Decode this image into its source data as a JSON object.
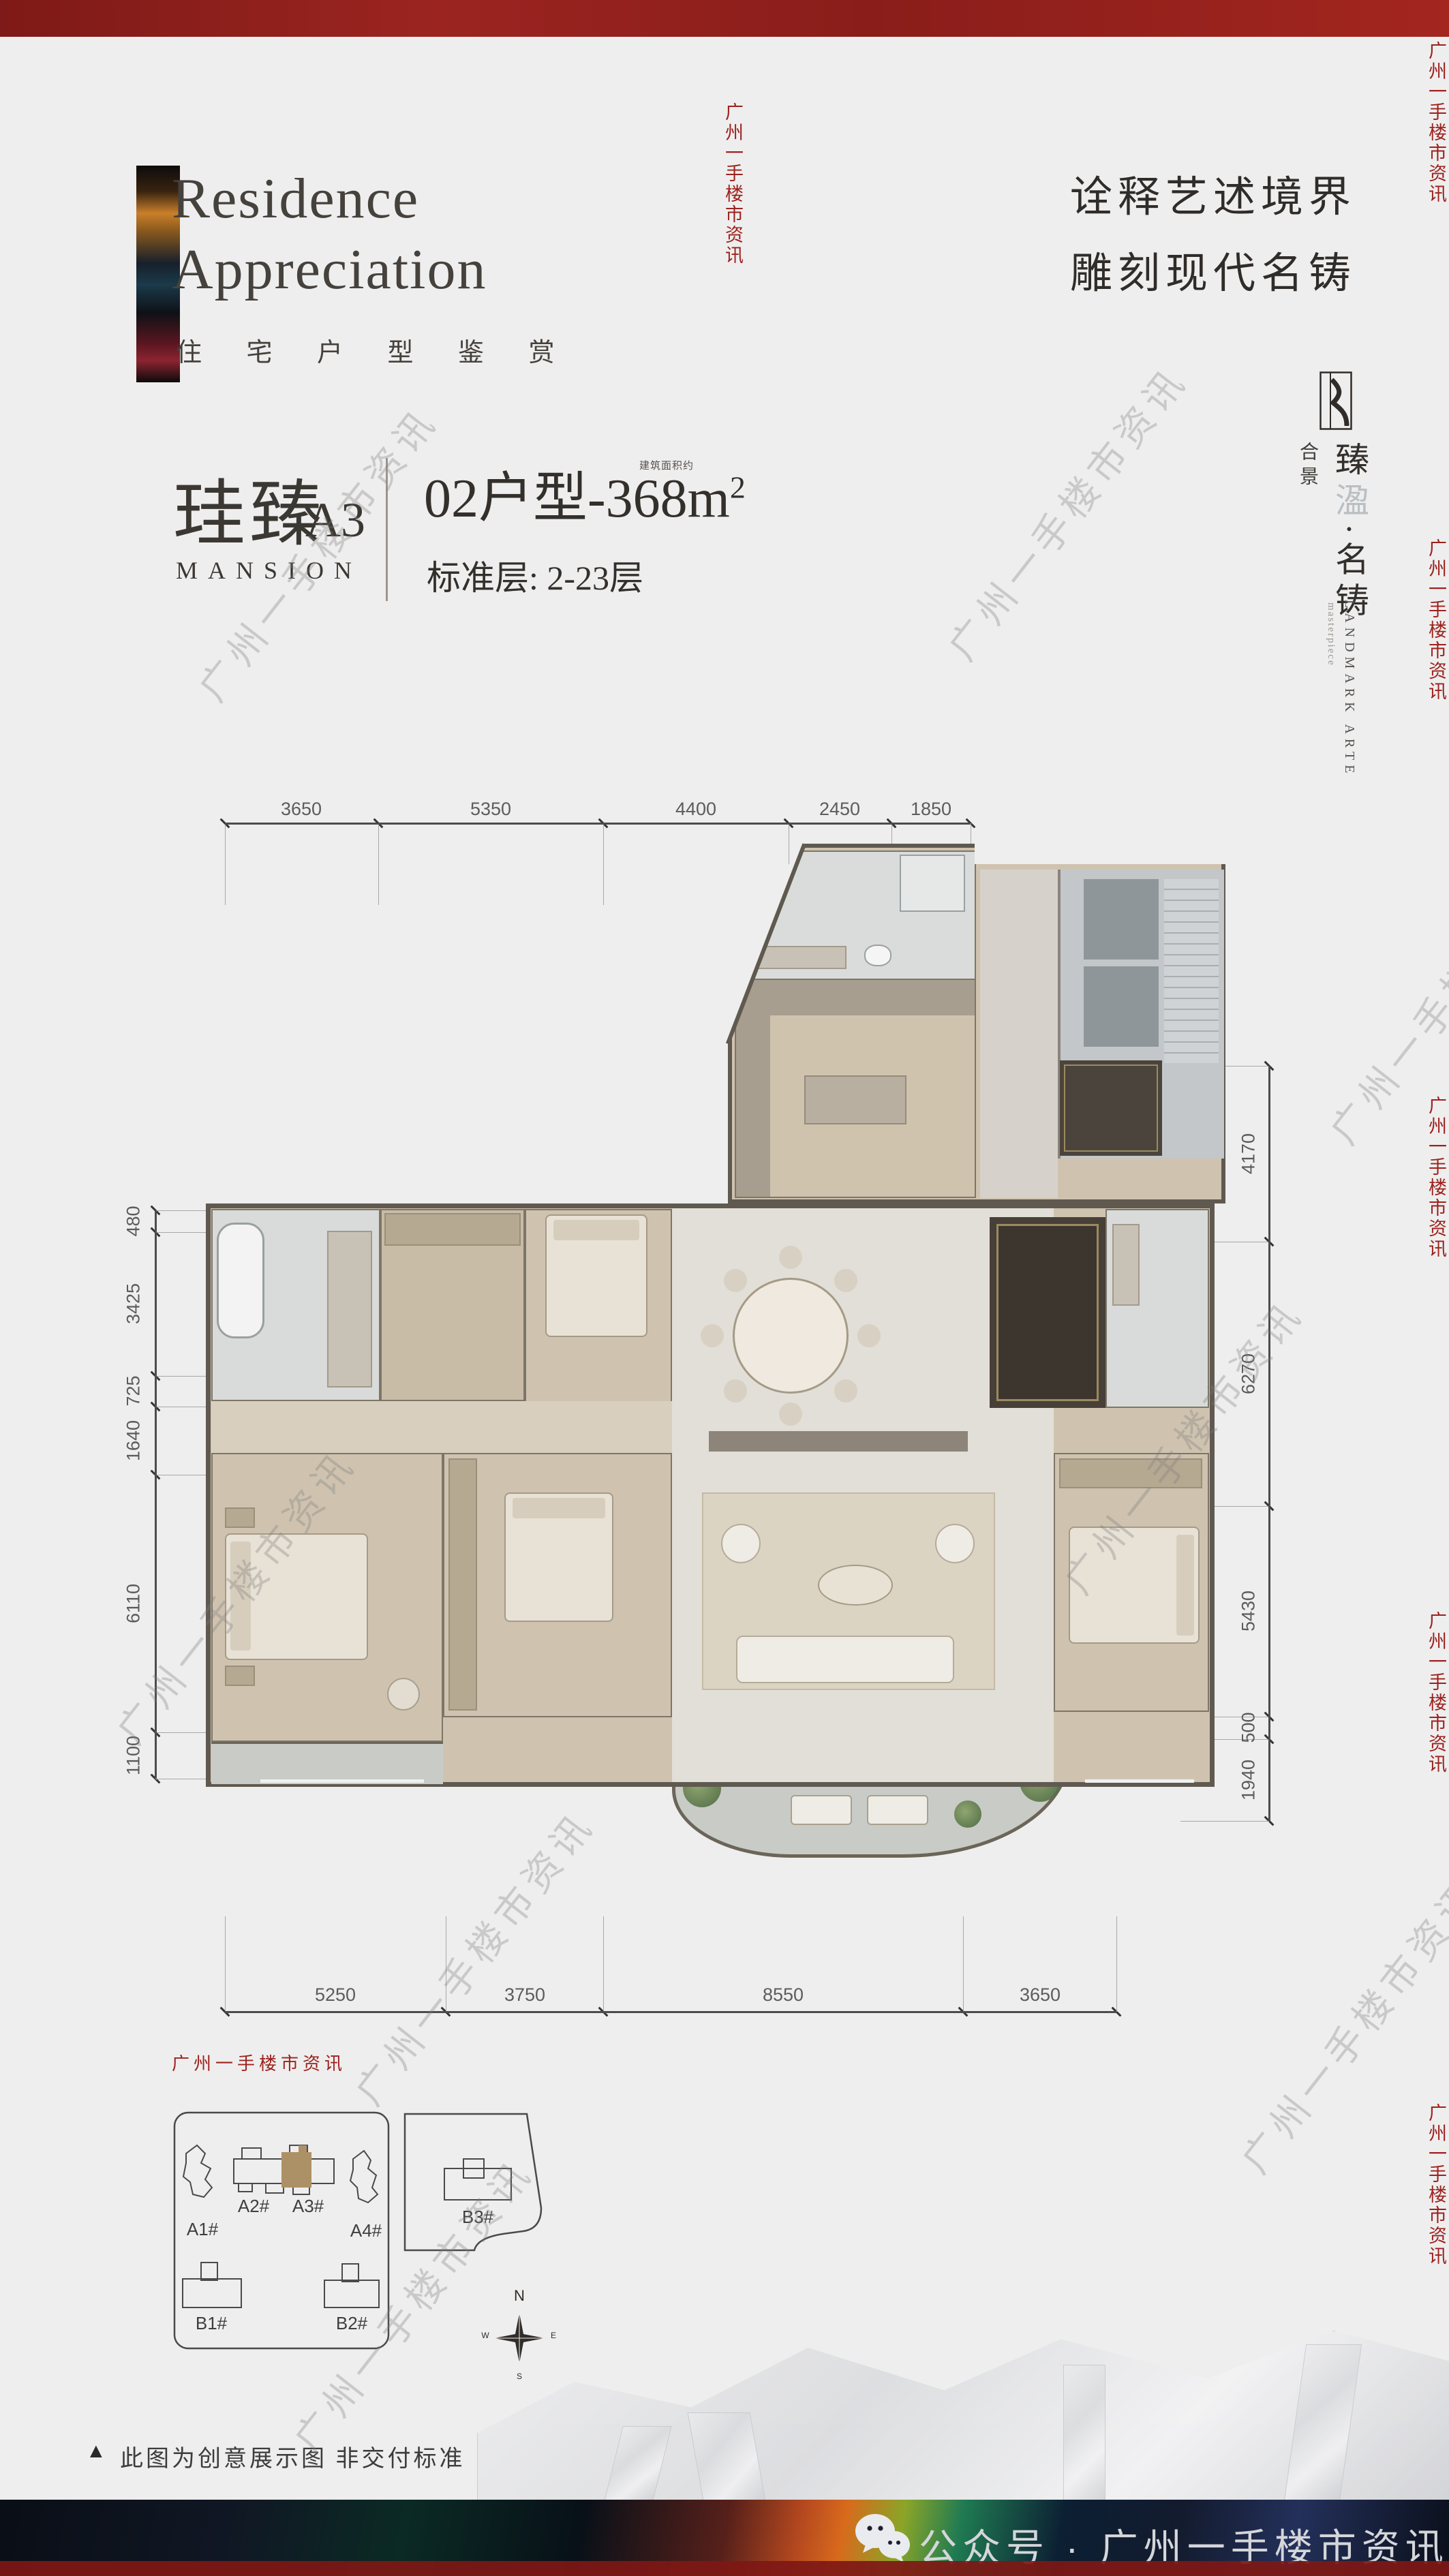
{
  "header": {
    "title_line1": "Residence",
    "title_line2": "Appreciation",
    "subtitle_zh": "住 宅 户 型 鉴 赏",
    "headline_line1": "诠释艺述境界",
    "headline_line2": "雕刻现代名铸"
  },
  "brand": {
    "prefix": "合景",
    "name_part1": "臻",
    "name_part2": "溋",
    "name_part3": "·名铸",
    "en": "LANDMARK ARTE",
    "en_sub": "masterpiece"
  },
  "unit": {
    "name_zh": "珪臻",
    "code": "A3",
    "name_en": "MANSION",
    "type_title": "02户型-368m",
    "type_sup": "2",
    "area_note": "建筑面积约",
    "floor_info": "标准层: 2-23层"
  },
  "floorplan": {
    "dims": {
      "top": [
        "3650",
        "5350",
        "4400",
        "2450",
        "1850"
      ],
      "bottom": [
        "5250",
        "3750",
        "8550",
        "3650"
      ],
      "left": [
        "480",
        "3425",
        "725",
        "1640",
        "6110",
        "1100"
      ],
      "right": [
        "4170",
        "6270",
        "5430",
        "500",
        "1940"
      ]
    }
  },
  "siteplan": {
    "towers": [
      "A1#",
      "A2#",
      "A3#",
      "A4#",
      "B1#",
      "B2#",
      "B3#"
    ],
    "highlighted_tower": "A3#",
    "compass": {
      "n": "N",
      "e": "E",
      "s": "S",
      "w": "W"
    }
  },
  "note": {
    "marker": "▲",
    "text": "此图为创意展示图  非交付标准"
  },
  "footer": {
    "account_label": "公众号 · 广州一手楼市资讯"
  },
  "watermark": {
    "text": "广州一手楼市资讯"
  },
  "colors": {
    "accent_red": "#9c221e",
    "highlight_gold": "#ad9166",
    "wall": "#5f5950",
    "background": "#efeeee",
    "footer_text": "#d4d6da"
  }
}
